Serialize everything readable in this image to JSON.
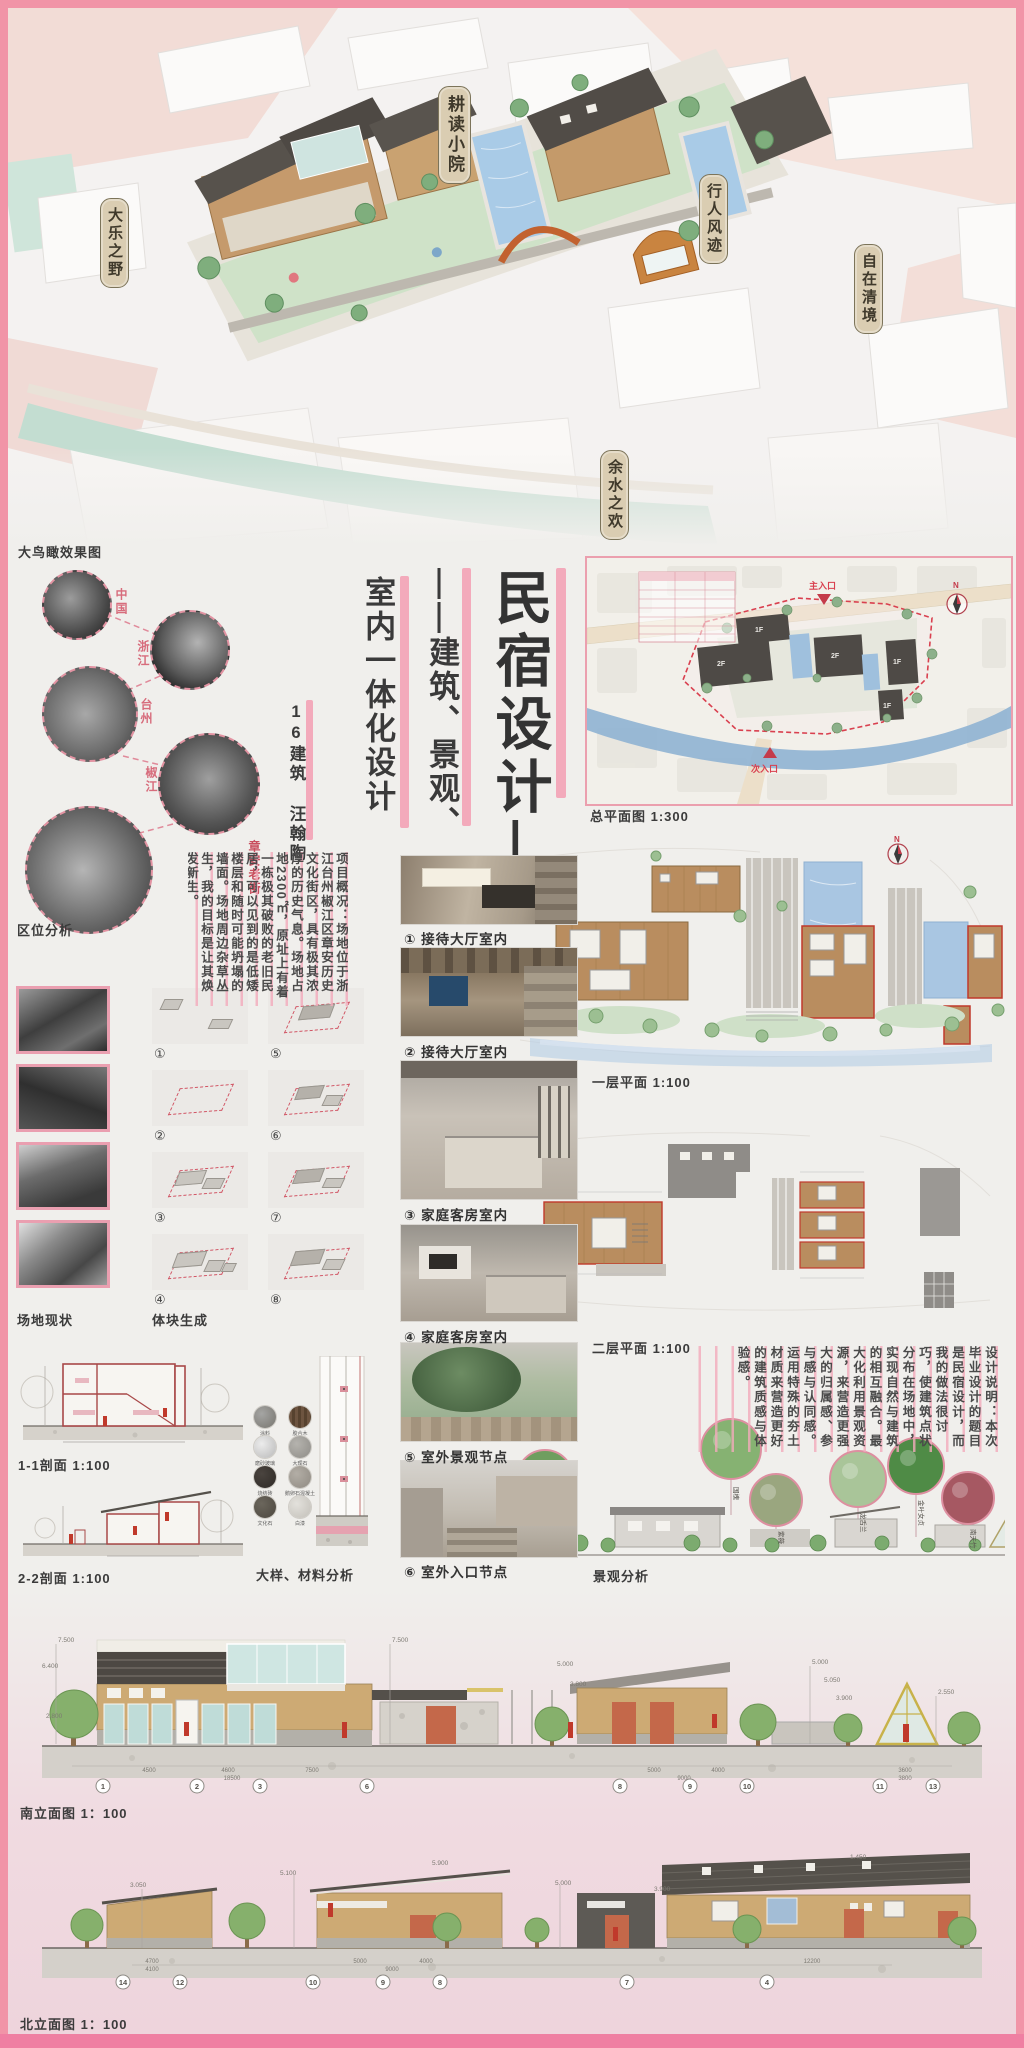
{
  "hero": {
    "caption": "大鸟瞰效果图",
    "labels": [
      "耕读小院",
      "大乐之野",
      "行人风迹",
      "自在清境",
      "余水之欢"
    ]
  },
  "location": {
    "caption": "区位分析",
    "nodes": [
      "中国",
      "浙江",
      "台州",
      "椒江",
      "章安老街"
    ]
  },
  "title": {
    "main": "民宿设计—",
    "sub1": "——建筑、景观、",
    "sub2": "室内一体化设计",
    "author": "16建筑 汪翰陶"
  },
  "overview": "项目概况：场地位于浙江台州椒江区章安历史文化街区，具有极其浓厚的历史气息。场地占地2300㎡，原址上有着一栋极其破败的老旧民居，可以见到的是低矮楼层和随时可能坍塌的墙面。场地周边杂草丛生，我的目标是让其焕发新生。",
  "site_plan": {
    "caption": "总平面图 1:300",
    "main_entry": "主入口",
    "side_entry": "次入口",
    "north": "N",
    "tags": [
      "1F",
      "2F",
      "2F",
      "1F",
      "1F"
    ]
  },
  "floor_plans": {
    "first": "一层平面 1:100",
    "second": "二层平面 1:100",
    "north": "N"
  },
  "photo_captions": [
    "① 接待大厅室内",
    "② 接待大厅室内",
    "③ 家庭客房室内",
    "④ 家庭客房室内",
    "⑤ 室外景观节点",
    "⑥ 室外入口节点"
  ],
  "site_photos_caption": "场地现状",
  "massing": {
    "caption": "体块生成",
    "steps": [
      "①",
      "②",
      "③",
      "④",
      "⑤",
      "⑥",
      "⑦",
      "⑧"
    ]
  },
  "sections": {
    "s1": "1-1剖面 1:100",
    "s2": "2-2剖面 1:100"
  },
  "materials": {
    "caption": "大样、材料分析",
    "labels": [
      "涂料",
      "胶合木",
      "磨砂玻璃",
      "大理石",
      "烧结砖",
      "鹅卵石混凝土",
      "文化石",
      "白漆"
    ]
  },
  "design_note": "设计说明：本次毕业设计的题目是民宿设计，而我的做法很讨巧，使建筑点状分布在场地中，实现自然与建筑的相互融合。最大化利用景观资源，来营造更强大的归属感、参与感与认同感。运用特殊的夯土材质来营造更好的建筑质感与体验感。",
  "landscape": {
    "caption": "景观分析",
    "plants": [
      "无花果",
      "国槐",
      "紫薇",
      "龙舌兰",
      "金叶女贞",
      "南天竹"
    ]
  },
  "south_elev": {
    "caption": "南立面图 1：100",
    "grids": [
      "1",
      "2",
      "3",
      "6",
      "8",
      "9",
      "10",
      "11",
      "13"
    ],
    "dims": [
      "7.500",
      "6.400",
      "2.800",
      "7.500",
      "5.000",
      "3.800",
      "5.000",
      "5.050",
      "3.900",
      "2.550"
    ],
    "spans": [
      "4500",
      "4600",
      "7500",
      "18500",
      "5000",
      "4000",
      "9000",
      "3600",
      "3800"
    ]
  },
  "north_elev": {
    "caption": "北立面图 1：100",
    "grids": [
      "14",
      "12",
      "10",
      "9",
      "8",
      "7",
      "4"
    ],
    "dims": [
      "3.050",
      "5.100",
      "5.900",
      "5.000",
      "3.900",
      "1.450"
    ],
    "spans": [
      "4700",
      "4100",
      "5000",
      "4000",
      "9000",
      "12200"
    ]
  }
}
